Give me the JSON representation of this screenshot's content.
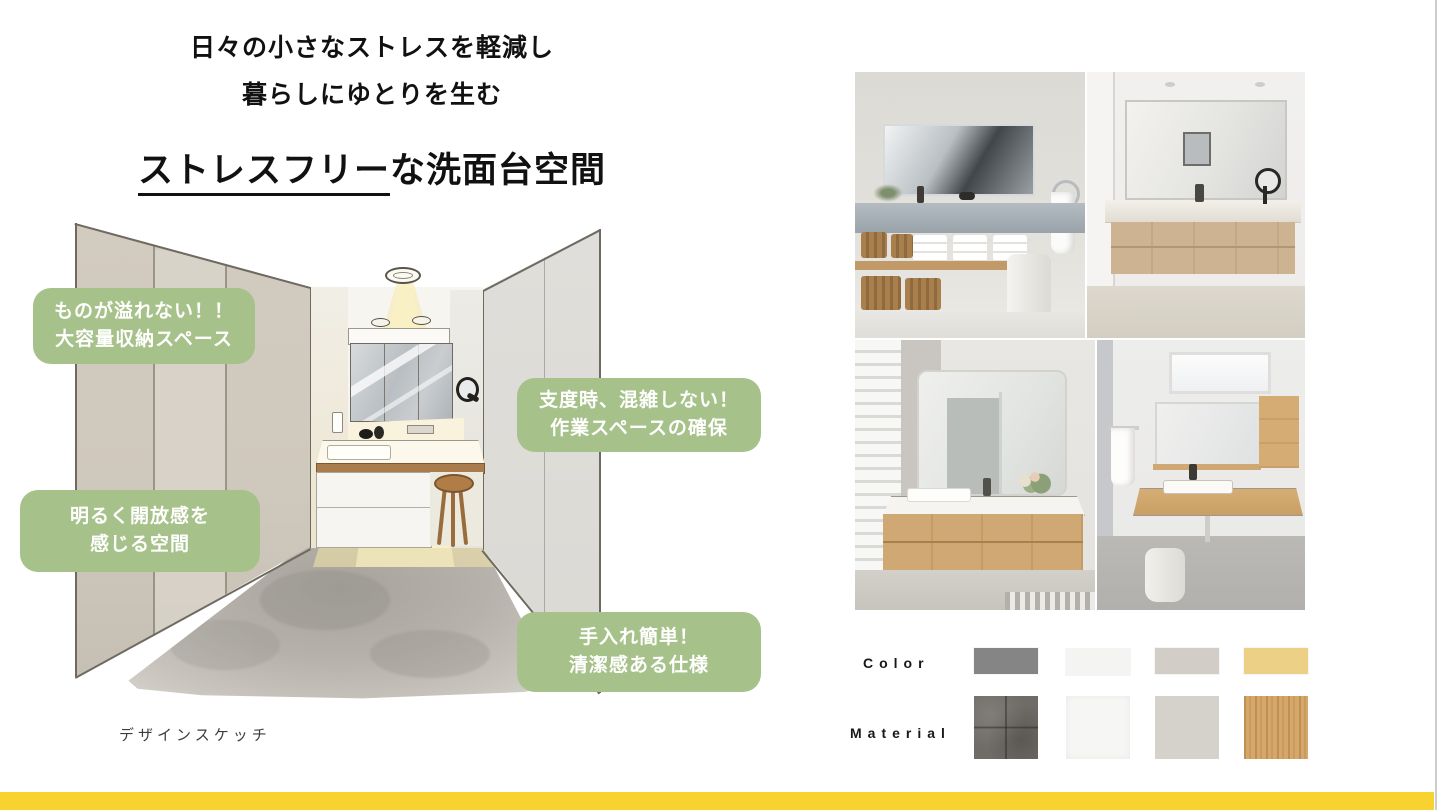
{
  "header": {
    "line1": "日々の小さなストレスを軽減し",
    "line2": "暮らしにゆとりを生む",
    "title_em": "ストレスフリー",
    "title_rest": "な洗面台空間"
  },
  "sketch": {
    "caption": "デザインスケッチ",
    "badge_color": "#a6c18a",
    "badges": [
      {
        "line1": "ものが溢れない！！",
        "line2": "大容量収納スペース"
      },
      {
        "line1": "支度時、混雑しない！",
        "line2": "作業スペースの確保"
      },
      {
        "line1": "明るく開放感を",
        "line2": "感じる空間"
      },
      {
        "line1": "手入れ簡単！",
        "line2": "清潔感ある仕様"
      }
    ]
  },
  "photos": {
    "items": [
      {
        "name": "concrete-counter-open-shelf-vanity-photo"
      },
      {
        "name": "wood-drawer-marble-counter-vanity-photo"
      },
      {
        "name": "floating-wood-vanity-large-mirror-photo"
      },
      {
        "name": "wood-counter-wall-cabinet-vanity-photo"
      }
    ]
  },
  "palette": {
    "color_label": "Color",
    "material_label": "Material",
    "colors": [
      {
        "name": "gray",
        "hex": "#858585"
      },
      {
        "name": "off-white",
        "hex": "#f4f4f2"
      },
      {
        "name": "greige",
        "hex": "#d2cec7"
      },
      {
        "name": "yellow",
        "hex": "#ebd085"
      }
    ],
    "materials": [
      {
        "name": "concrete-tile",
        "hex": "#6f6b67"
      },
      {
        "name": "white-paper",
        "hex": "#f6f6f4"
      },
      {
        "name": "plain-greige",
        "hex": "#d5d1cb"
      },
      {
        "name": "wood-grain",
        "hex": "#d5a76b"
      }
    ]
  },
  "footer": {
    "accent_bar_color": "#f8d22e"
  }
}
